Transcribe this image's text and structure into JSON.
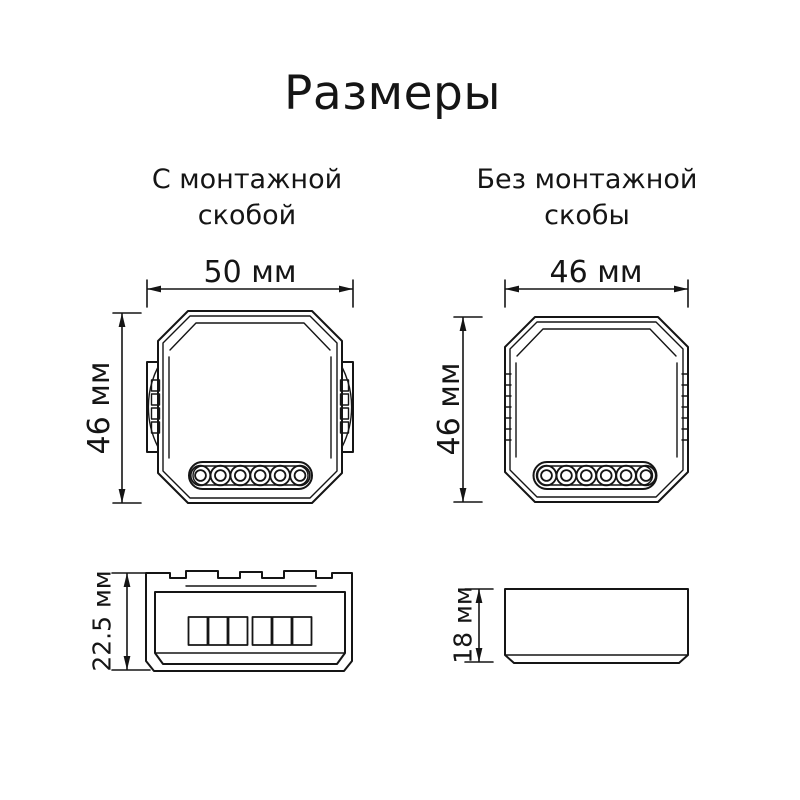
{
  "title": "Размеры",
  "colors": {
    "background": "#ffffff",
    "line_color": "#151515",
    "text_color": "#151515"
  },
  "with_bracket": {
    "subtitle_line1": "С монтажной",
    "subtitle_line2": "скобой",
    "top_view": {
      "width": "50 мм",
      "height": "46 мм"
    },
    "side_view": {
      "height": "22.5 мм"
    }
  },
  "without_bracket": {
    "subtitle_line1": "Без монтажной",
    "subtitle_line2": "скобы",
    "top_view": {
      "width": "46 мм",
      "height": "46 мм"
    },
    "side_view": {
      "height": "18 мм"
    }
  }
}
